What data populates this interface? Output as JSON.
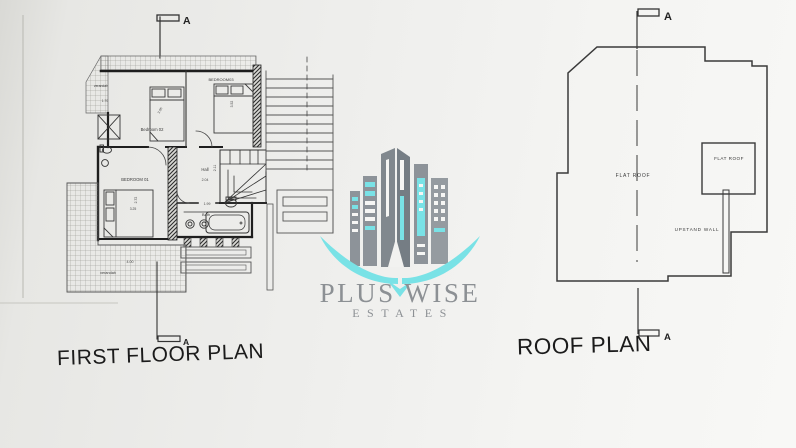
{
  "first_floor": {
    "title": "FIRST FLOOR PLAN",
    "section_top_letter": "A",
    "section_bottom_letter": "A",
    "rooms": {
      "bedroom1": "BEDROOM 01",
      "bedroom2": "Bedroom 02",
      "bedroom3": "BEDROOM03",
      "hall": "Hall",
      "bath": "Bath",
      "verandah_top": "verandah",
      "verandah_bottom": "verandah"
    },
    "dimensions": {
      "verandah_top": "1.70",
      "bedroom2": "3.05",
      "bedroom3": "3.52",
      "bedroom1_width": "3.25",
      "bedroom1_depth": "2.72",
      "hall_width": "2.04",
      "hall_depth": "2.11",
      "bath": "1.99",
      "verandah_bottom": "4.00"
    }
  },
  "roof": {
    "title": "ROOF PLAN",
    "section_top_letter": "A",
    "section_bottom_letter": "A",
    "labels": {
      "flat_roof_main": "FLAT ROOF",
      "flat_roof_small": "FLAT ROOF",
      "upstand_wall": "UPSTAND WALL"
    }
  },
  "watermark": {
    "brand": "PLUS WISE",
    "subtitle": "ESTATES",
    "colors": {
      "teal": "#79e2e6",
      "gray": "#8d9399"
    }
  }
}
